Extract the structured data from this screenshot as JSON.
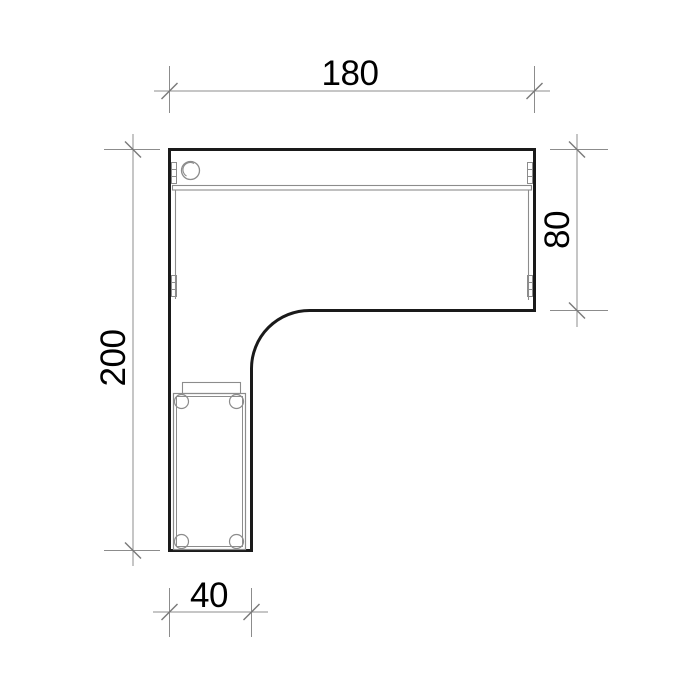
{
  "drawing": {
    "type": "technical-plan-view",
    "subject": "L-shaped corner desk, top view, with mobile pedestal",
    "dimensions": {
      "top_width": {
        "label": "180",
        "value": 180
      },
      "right_depth": {
        "label": "80",
        "value": 80
      },
      "left_height": {
        "label": "200",
        "value": 200
      },
      "bottom_leg_width": {
        "label": "40",
        "value": 40
      }
    },
    "features": {
      "cable_grommet": "round grommet hole near top-left corner",
      "back_rail": "double-line rail along inside of top edge",
      "side_panels": "thin panel lines with cam-connector marks on left and right inner edges",
      "pedestal": "drawer unit with four casters inside bottom leg",
      "inner_corner_radius_px": 58
    },
    "colors": {
      "background": "#ffffff",
      "outline": "#1a1a1a",
      "detail": "#8c8c8c",
      "dimension": "#8c8c8c",
      "tick": "#7a7a7a",
      "text": "#000000"
    }
  }
}
